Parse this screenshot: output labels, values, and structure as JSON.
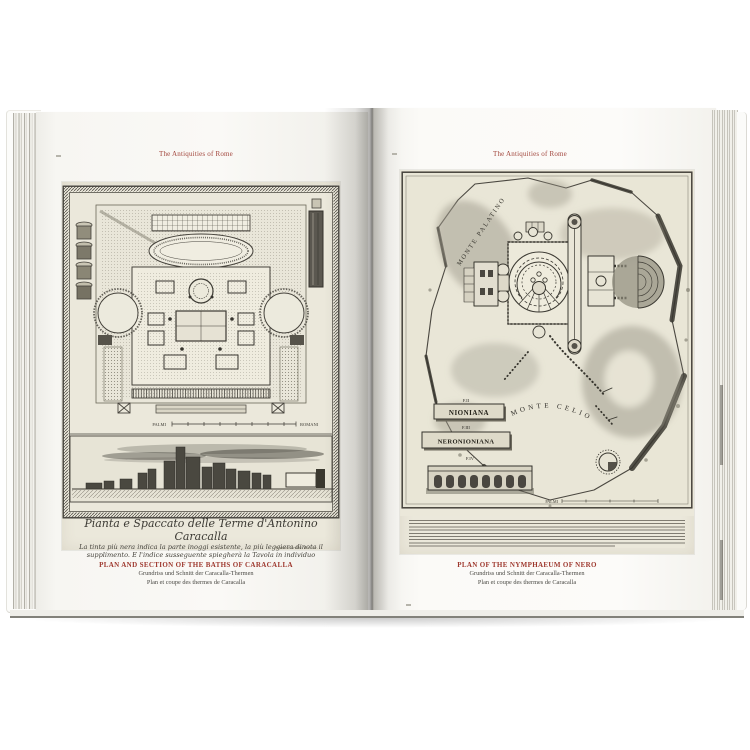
{
  "colors": {
    "background": "#ffffff",
    "accent_red": "#a03a31",
    "page_paper": "#f7f6f2",
    "plate_paper": "#ebe8db",
    "engraving_ink": "#3c3a33"
  },
  "left_page": {
    "header": "The Antiquities of Rome",
    "plate": {
      "script_title": "Pianta e Spaccato delle Terme d'Antonino Caracalla",
      "script_line_2": "La tinta più nera indica la parte inoggi esistente, la più leggiera dinota il",
      "script_line_3": "supplimento. E l'indice susseguente spiegherà la Tavola in individuo",
      "signature": "Piranesi Archit. dis. inc.",
      "scale_label_left": "PALMI",
      "scale_label_right": "ROMANI"
    },
    "caption": {
      "title": "PLAN AND SECTION OF THE BATHS OF CARACALLA",
      "subtitle_german": "Grundriss und Schnitt der Caracalla-Thermen",
      "subtitle_french": "Plan et coupe des thermes de Caracalla"
    }
  },
  "right_page": {
    "header": "The Antiquities of Rome",
    "plate": {
      "label_monte_palatino": "MONTE PALATINO",
      "label_monte_celio": "MONTE CELIO",
      "fragment_label_2": "F.II",
      "fragment_label_3": "F.III",
      "fragment_label_4": "F.IV",
      "tablet_1_text": "NIONIANA",
      "tablet_2_text": "NERONIONIANA",
      "scale_label": "PALMI"
    },
    "caption": {
      "title": "PLAN OF THE NYMPHAEUM OF NERO",
      "subtitle_german": "Grundriss und Schnitt der Caracalla-Thermen",
      "subtitle_french": "Plan et coupe des thermes de Caracalla"
    }
  }
}
